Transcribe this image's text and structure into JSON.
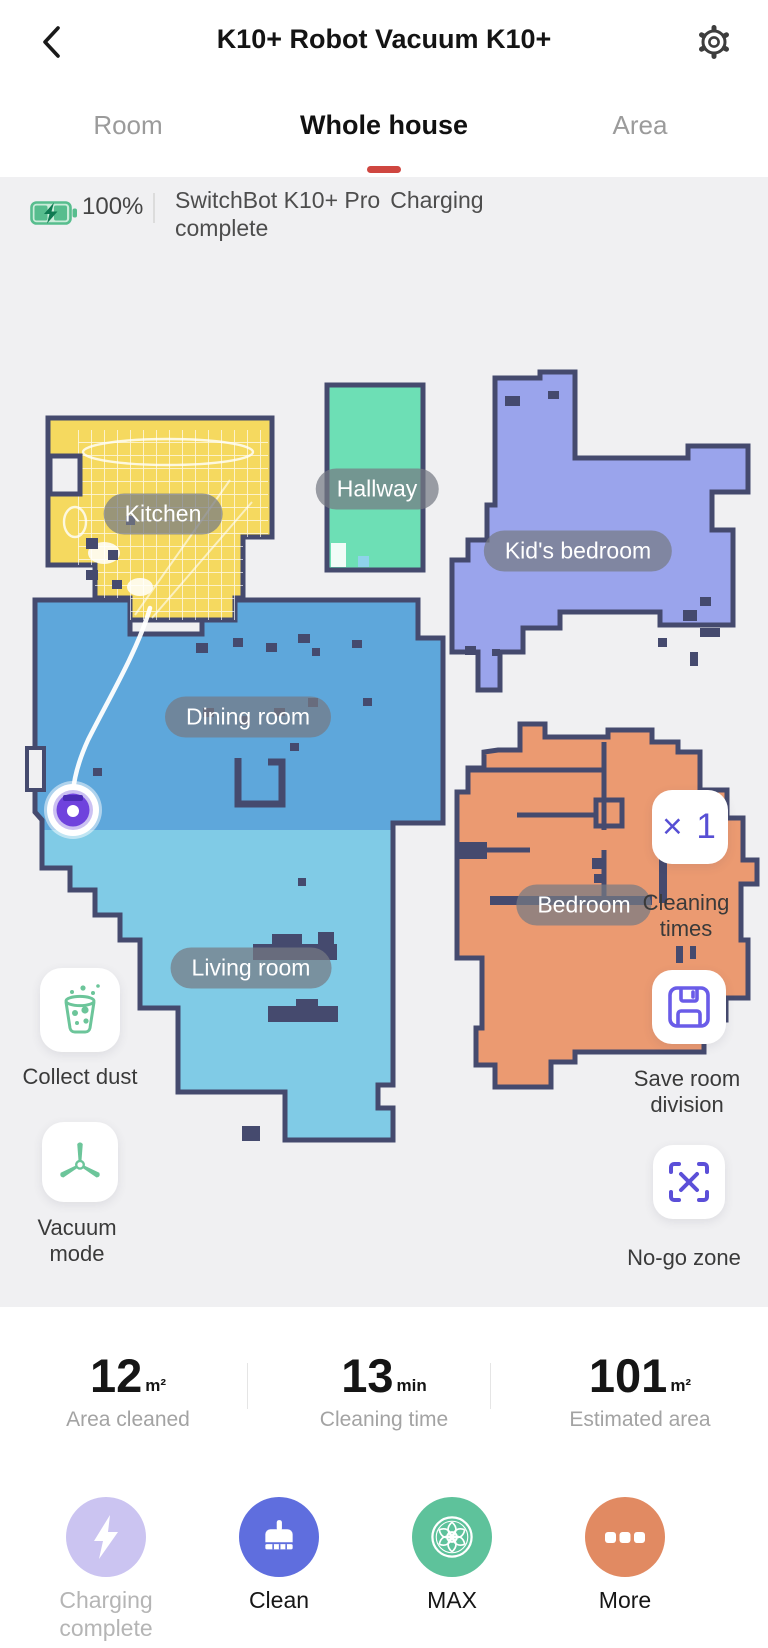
{
  "header": {
    "title": "K10+ Robot Vacuum K10+"
  },
  "tabs": {
    "room": "Room",
    "whole_house": "Whole house",
    "area": "Area"
  },
  "status": {
    "battery": "100%",
    "device": "SwitchBot K10+ Pro",
    "state": "Charging complete"
  },
  "map": {
    "wall_color": "#454a6e",
    "rooms": {
      "kitchen": {
        "label": "Kitchen",
        "color": "#f5d95f"
      },
      "hallway": {
        "label": "Hallway",
        "color": "#6ddfb5"
      },
      "kids_bedroom": {
        "label": "Kid's bedroom",
        "color": "#9aa4ec"
      },
      "dining_room": {
        "label": "Dining room",
        "color": "#5ea7db"
      },
      "living_room": {
        "label": "Living room",
        "color": "#80cbe6"
      },
      "bedroom": {
        "label": "Bedroom",
        "color": "#eb9a71"
      }
    }
  },
  "controls": {
    "cleaning_times_value": "× 1",
    "cleaning_times_label": "Cleaning times",
    "save_room_label": "Save room division",
    "no_go_label": "No-go zone",
    "collect_dust_label": "Collect dust",
    "vacuum_mode_label": "Vacuum mode"
  },
  "stats": [
    {
      "value": "12",
      "unit": "m²",
      "label": "Area cleaned"
    },
    {
      "value": "13",
      "unit": "min",
      "label": "Cleaning time"
    },
    {
      "value": "101",
      "unit": "m²",
      "label": "Estimated area"
    }
  ],
  "actions": [
    {
      "label": "Charging complete",
      "color": "#cbc4f1",
      "disabled": true
    },
    {
      "label": "Clean",
      "color": "#5f6ede",
      "disabled": false
    },
    {
      "label": "MAX",
      "color": "#5ec29b",
      "disabled": false
    },
    {
      "label": "More",
      "color": "#e18a62",
      "disabled": false
    }
  ]
}
